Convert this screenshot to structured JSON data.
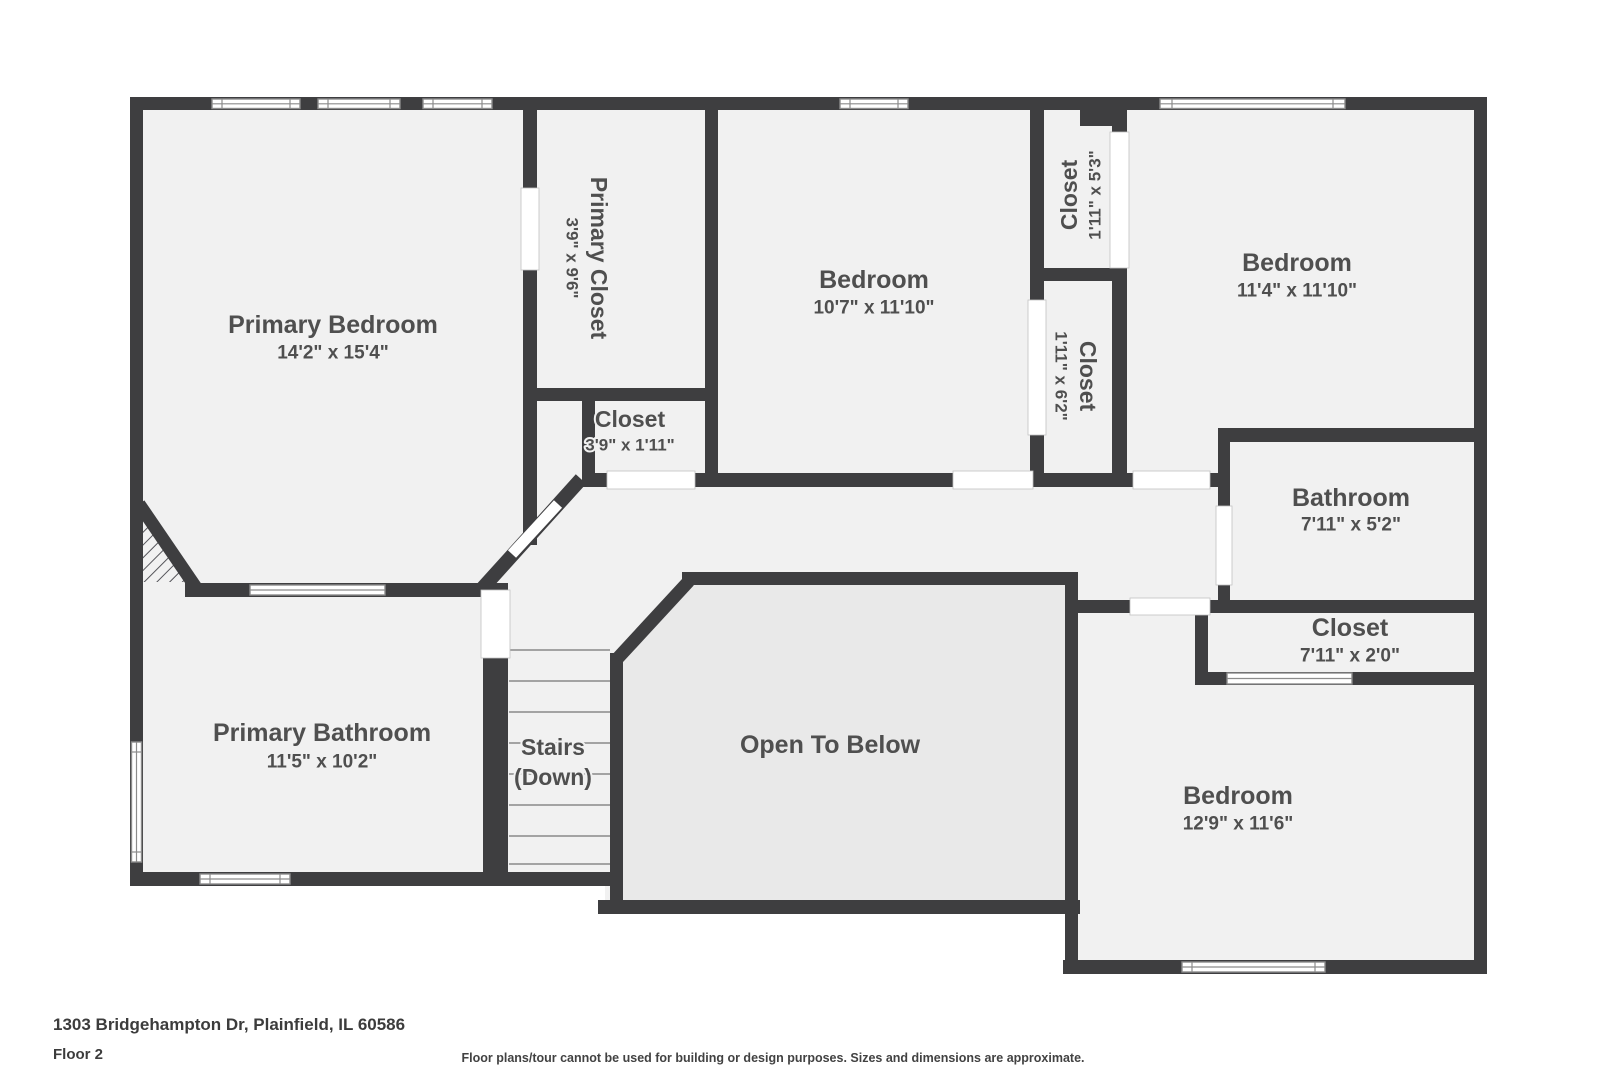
{
  "colors": {
    "wall": "#3e3e40",
    "floor": "#f1f1f1",
    "otb": "#e9e9e9",
    "text": "#4f4f4f",
    "line": "#8c8c8c",
    "bg": "#ffffff"
  },
  "rooms": [
    {
      "name": "Primary Bedroom",
      "dims": "14'2\" x 15'4\""
    },
    {
      "name": "Primary Closet",
      "dims": "3'9\" x 9'6\""
    },
    {
      "name": "Closet",
      "dims": "3'9\" x 1'11\""
    },
    {
      "name": "Bedroom",
      "dims": "10'7\" x 11'10\""
    },
    {
      "name": "Closet",
      "dims": "1'11\" x 5'3\""
    },
    {
      "name": "Closet",
      "dims": "1'11\" x 6'2\""
    },
    {
      "name": "Bedroom",
      "dims": "11'4\" x 11'10\""
    },
    {
      "name": "Bathroom",
      "dims": "7'11\" x 5'2\""
    },
    {
      "name": "Closet",
      "dims": "7'11\" x 2'0\""
    },
    {
      "name": "Primary Bathroom",
      "dims": "11'5\" x 10'2\""
    },
    {
      "name": "Bedroom",
      "dims": "12'9\" x 11'6\""
    }
  ],
  "areas": {
    "stairs": {
      "line1": "Stairs",
      "line2": "(Down)"
    },
    "open_to_below": "Open To Below"
  },
  "footer": {
    "address": "1303 Bridgehampton Dr, Plainfield, IL 60586",
    "floor": "Floor 2",
    "disclaimer": "Floor plans/tour cannot be used for building or design purposes. Sizes and dimensions are approximate."
  }
}
